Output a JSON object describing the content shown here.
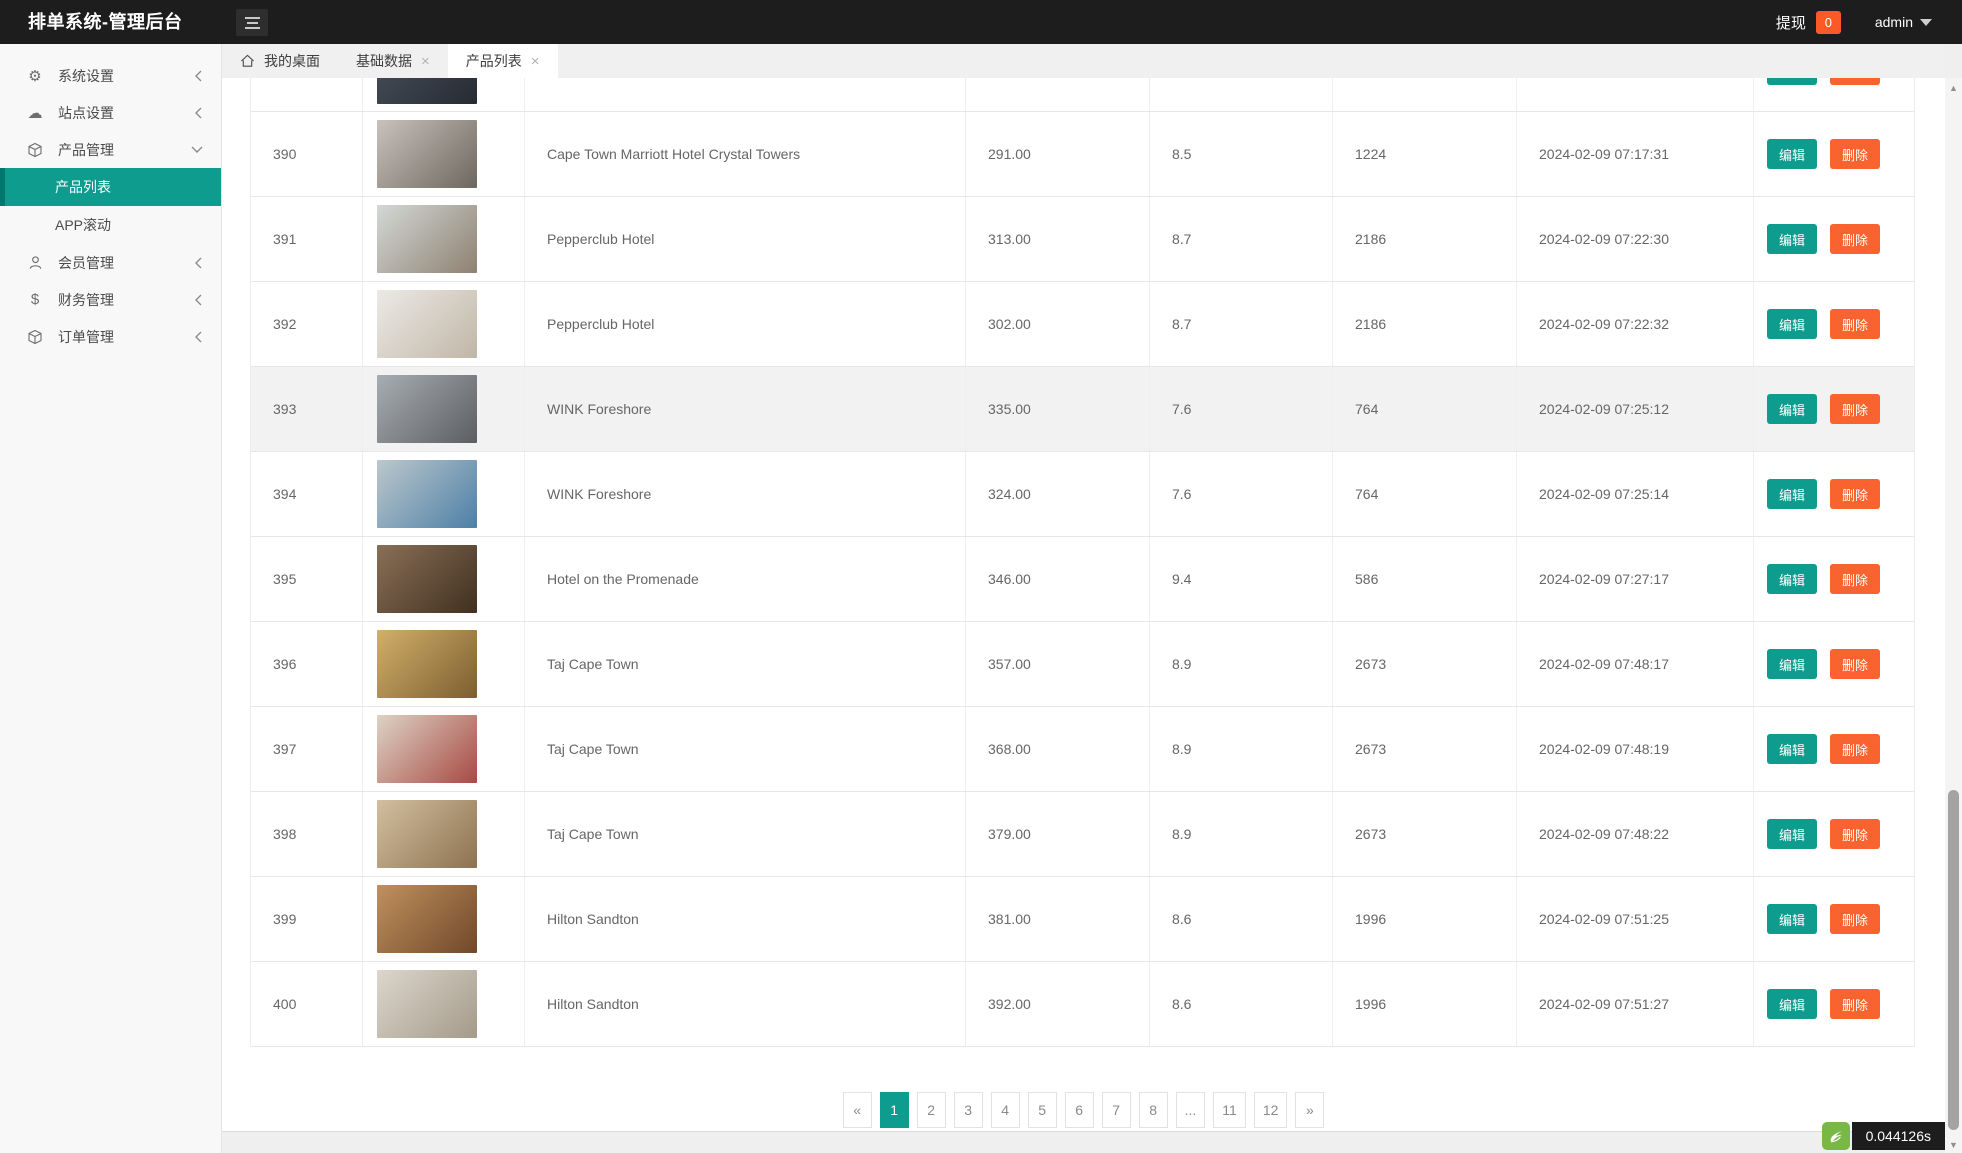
{
  "header": {
    "title": "排单系统-管理后台",
    "withdraw_label": "提现",
    "withdraw_count": "0",
    "username": "admin"
  },
  "sidebar": {
    "items": [
      {
        "label": "系统设置",
        "icon": "gear-icon"
      },
      {
        "label": "站点设置",
        "icon": "cloud-icon"
      },
      {
        "label": "产品管理",
        "icon": "cube-icon",
        "expanded": true
      },
      {
        "label": "会员管理",
        "icon": "user-icon"
      },
      {
        "label": "财务管理",
        "icon": "dollar-icon"
      },
      {
        "label": "订单管理",
        "icon": "cube-icon"
      }
    ],
    "submenu": [
      {
        "label": "产品列表",
        "active": true
      },
      {
        "label": "APP滚动"
      }
    ]
  },
  "tabs": [
    {
      "label": "我的桌面"
    },
    {
      "label": "基础数据"
    },
    {
      "label": "产品列表"
    }
  ],
  "actions": {
    "edit": "编辑",
    "delete": "删除"
  },
  "table": {
    "partial_row": {
      "img": [
        "#4a525e",
        "#262b33"
      ]
    },
    "rows": [
      {
        "id": "390",
        "name": "Cape Town Marriott Hotel Crystal Towers",
        "price": "291.00",
        "score": "8.5",
        "sales": "1224",
        "time": "2024-02-09 07:17:31",
        "img": [
          "#c7c2bb",
          "#6e6760"
        ]
      },
      {
        "id": "391",
        "name": "Pepperclub Hotel",
        "price": "313.00",
        "score": "8.7",
        "sales": "2186",
        "time": "2024-02-09 07:22:30",
        "img": [
          "#d3d8d6",
          "#8e8171"
        ]
      },
      {
        "id": "392",
        "name": "Pepperclub Hotel",
        "price": "302.00",
        "score": "8.7",
        "sales": "2186",
        "time": "2024-02-09 07:22:32",
        "img": [
          "#eceae6",
          "#c0b6a6"
        ]
      },
      {
        "id": "393",
        "name": "WINK Foreshore",
        "price": "335.00",
        "score": "7.6",
        "sales": "764",
        "time": "2024-02-09 07:25:12",
        "img": [
          "#a8adb2",
          "#5b5e62"
        ],
        "hl": true
      },
      {
        "id": "394",
        "name": "WINK Foreshore",
        "price": "324.00",
        "score": "7.6",
        "sales": "764",
        "time": "2024-02-09 07:25:14",
        "img": [
          "#bcc7cc",
          "#4d80a6"
        ]
      },
      {
        "id": "395",
        "name": "Hotel on the Promenade",
        "price": "346.00",
        "score": "9.4",
        "sales": "586",
        "time": "2024-02-09 07:27:17",
        "img": [
          "#8a6f57",
          "#40301f"
        ]
      },
      {
        "id": "396",
        "name": "Taj Cape Town",
        "price": "357.00",
        "score": "8.9",
        "sales": "2673",
        "time": "2024-02-09 07:48:17",
        "img": [
          "#d1b06a",
          "#7d5e2f"
        ]
      },
      {
        "id": "397",
        "name": "Taj Cape Town",
        "price": "368.00",
        "score": "8.9",
        "sales": "2673",
        "time": "2024-02-09 07:48:19",
        "img": [
          "#ddd3c4",
          "#a84a44"
        ]
      },
      {
        "id": "398",
        "name": "Taj Cape Town",
        "price": "379.00",
        "score": "8.9",
        "sales": "2673",
        "time": "2024-02-09 07:48:22",
        "img": [
          "#d2bf9f",
          "#8d7250"
        ]
      },
      {
        "id": "399",
        "name": "Hilton Sandton",
        "price": "381.00",
        "score": "8.6",
        "sales": "1996",
        "time": "2024-02-09 07:51:25",
        "img": [
          "#c0905e",
          "#70492a"
        ]
      },
      {
        "id": "400",
        "name": "Hilton Sandton",
        "price": "392.00",
        "score": "8.6",
        "sales": "1996",
        "time": "2024-02-09 07:51:27",
        "img": [
          "#dcd6cc",
          "#a49a8a"
        ]
      }
    ]
  },
  "pagination": {
    "items": [
      {
        "label": "«"
      },
      {
        "label": "1",
        "active": true
      },
      {
        "label": "2"
      },
      {
        "label": "3"
      },
      {
        "label": "4"
      },
      {
        "label": "5"
      },
      {
        "label": "6"
      },
      {
        "label": "7"
      },
      {
        "label": "8"
      },
      {
        "label": "..."
      },
      {
        "label": "11"
      },
      {
        "label": "12"
      },
      {
        "label": "»"
      }
    ]
  },
  "footer": {
    "load_time": "0.044126s"
  },
  "colors": {
    "header_bg": "#1d1d1d",
    "accent_teal": "#0d9c8e",
    "accent_orange": "#f9632f",
    "badge_orange": "#fb5a28",
    "timer_green": "#7ab845"
  }
}
